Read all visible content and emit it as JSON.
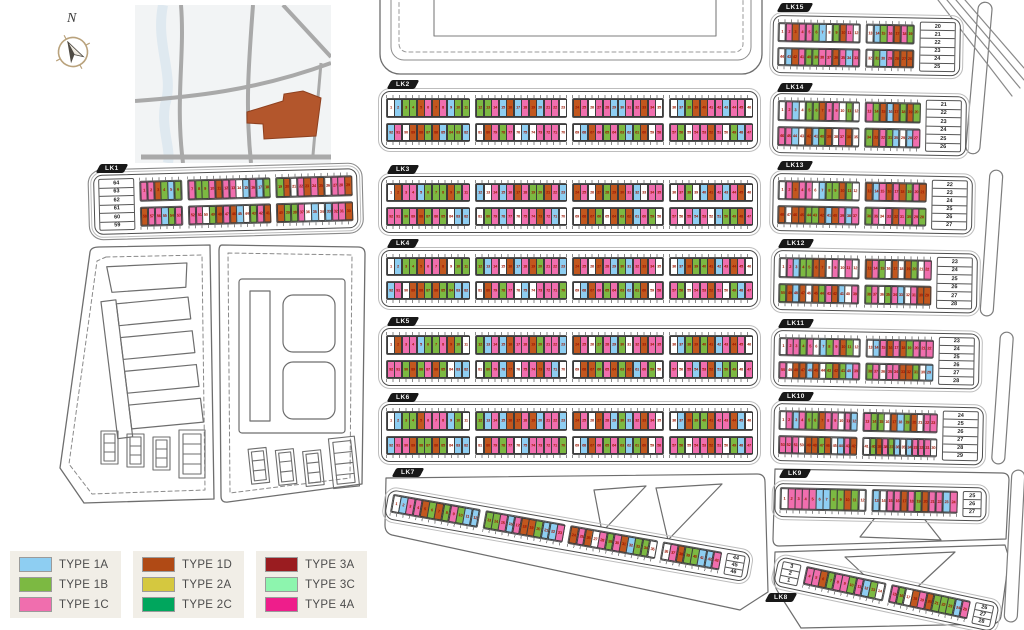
{
  "compass": {
    "label": "N"
  },
  "legend": {
    "items": [
      {
        "label": "TYPE 1A",
        "color": "#8ECEF2"
      },
      {
        "label": "TYPE 1B",
        "color": "#7CB942"
      },
      {
        "label": "TYPE 1C",
        "color": "#F06EAE"
      },
      {
        "label": "TYPE 1D",
        "color": "#B04A15"
      },
      {
        "label": "TYPE 2A",
        "color": "#D5C83F"
      },
      {
        "label": "TYPE 2C",
        "color": "#00A65D"
      },
      {
        "label": "TYPE 3A",
        "color": "#9A1C20"
      },
      {
        "label": "TYPE 3C",
        "color": "#8DF5AE"
      },
      {
        "label": "TYPE 4A",
        "color": "#EE1E8B"
      }
    ]
  },
  "palette": {
    "A": "#8ECEF2",
    "B": "#7CB942",
    "C": "#F06EAE",
    "D": "#C2571E",
    "E": "#D5C83F",
    "F": "#00A65D",
    "G": "#9A1C20",
    "H": "#8DF5AE",
    "I": "#EE1E8B",
    "W": "#FFFFFF"
  },
  "blocks": [
    {
      "id": "LK1",
      "label": "LK1",
      "kind": "tworow",
      "sideLeft": [
        64,
        63,
        62,
        61,
        60,
        59
      ],
      "groups": [
        {
          "t": [
            1,
            6
          ],
          "b": [
            58,
            53
          ]
        },
        {
          "t": [
            7,
            18
          ],
          "b": [
            52,
            41
          ]
        },
        {
          "t": [
            19,
            29
          ],
          "b": [
            40,
            30
          ]
        }
      ],
      "topColors": "CCDBABCBBCDCCWACABBDWCDCDWCCD",
      "bottomColors": "DCCABCCCWBDCDAWBCDDBBCWAWACCD"
    },
    {
      "id": "LK2",
      "label": "LK2",
      "kind": "tworow",
      "groups": [
        {
          "t": [
            1,
            11
          ],
          "b": [
            92,
            82
          ]
        },
        {
          "t": [
            12,
            23
          ],
          "b": [
            81,
            70
          ]
        },
        {
          "t": [
            24,
            35
          ],
          "b": [
            69,
            58
          ]
        },
        {
          "t": [
            36,
            46
          ],
          "b": [
            57,
            47
          ]
        }
      ],
      "topColors": "WABBDCDCABBBBCADACDACCWDCWCCAACCDCWWABDDCCACCW",
      "bottomColors": "ACWDDBDABBAWDCBCWAWCCCWWADCBCBABDWCCBWCCDCWBAC"
    },
    {
      "id": "LK3",
      "label": "LK3",
      "kind": "tworow",
      "groups": [
        {
          "t": [
            1,
            11
          ],
          "b": [
            92,
            82
          ]
        },
        {
          "t": [
            12,
            23
          ],
          "b": [
            81,
            70
          ]
        },
        {
          "t": [
            24,
            35
          ],
          "b": [
            69,
            58
          ]
        },
        {
          "t": [
            36,
            46
          ],
          "b": [
            57,
            47
          ]
        }
      ],
      "topColors": "WDCCABBBDBCAWCACDCBBDCADCWDBDDCAWCCWCBWADCACDW",
      "bottomColors": "CCBCDBCBWAAWBCACWCCDCAWWDDBWDBDACBWCWCACWABBDC"
    },
    {
      "id": "LK4",
      "label": "LK4",
      "kind": "tworow",
      "groups": [
        {
          "t": [
            1,
            11
          ],
          "b": [
            92,
            82
          ]
        },
        {
          "t": [
            12,
            23
          ],
          "b": [
            81,
            70
          ]
        },
        {
          "t": [
            24,
            35
          ],
          "b": [
            69,
            58
          ]
        },
        {
          "t": [
            36,
            46
          ],
          "b": [
            57,
            47
          ]
        }
      ],
      "topColors": "WABBDCCDWBBBACWDACDBCCADCWDCABACDCWWADBBDACDCW",
      "bottomColors": "ACWDDBDBBAAWDCBCWAWCCCBWADCBCBABDWCCBWCCDCWBAC"
    },
    {
      "id": "LK5",
      "label": "LK5",
      "kind": "tworow",
      "groups": [
        {
          "t": [
            1,
            11
          ],
          "b": [
            92,
            82
          ]
        },
        {
          "t": [
            12,
            23
          ],
          "b": [
            81,
            70
          ]
        },
        {
          "t": [
            24,
            35
          ],
          "b": [
            69,
            58
          ]
        },
        {
          "t": [
            36,
            46
          ],
          "b": [
            57,
            47
          ]
        }
      ],
      "topColors": "WDCCABBCDBWBACADCCDBCCADCWBCABWCDCCWABDBDACDCW",
      "bottomColors": "CCBDBCDBWAAWBCADWCCDCAWWDDBCDBDACBWCWCACDABBWC"
    },
    {
      "id": "LK6",
      "label": "LK6",
      "kind": "tworow",
      "groups": [
        {
          "t": [
            1,
            11
          ],
          "b": [
            92,
            82
          ]
        },
        {
          "t": [
            12,
            23
          ],
          "b": [
            81,
            70
          ]
        },
        {
          "t": [
            24,
            35
          ],
          "b": [
            69,
            58
          ]
        },
        {
          "t": [
            36,
            46
          ],
          "b": [
            57,
            47
          ]
        }
      ],
      "topColors": "WABBDCCCABWBACADDCDACCADCWDCABACDCWWADBBDCCDAW",
      "bottomColors": "ACCDBBDBWAAWDCBCWACCCCBWADCBCBABDWCCBWCCDCWBAC"
    },
    {
      "id": "LK7",
      "label": "LK7",
      "kind": "row",
      "groups": [
        {
          "r": [
            1,
            12
          ]
        },
        {
          "r": [
            13,
            23
          ]
        },
        {
          "r": [
            24,
            35
          ]
        },
        {
          "r": [
            36,
            43
          ]
        }
      ],
      "sideRight": [
        44,
        45,
        46
      ],
      "rowColors": "WACCDBDBCBAABBCACDDBAACDCDWCBCDABBWWCDBBAAC"
    },
    {
      "id": "LK8",
      "label": "LK8",
      "kind": "row",
      "sideLeft": [
        3,
        2,
        1
      ],
      "groups": [
        {
          "r": [
            4,
            14
          ]
        },
        {
          "r": [
            15,
            25
          ]
        }
      ],
      "sideRight": [
        26,
        27,
        28
      ],
      "rowColors": "CCDBCCBCABWCBWDCDBBBAC"
    },
    {
      "id": "LK9",
      "label": "LK9",
      "kind": "row",
      "groups": [
        {
          "r": [
            1,
            12
          ]
        },
        {
          "r": [
            13,
            24
          ]
        }
      ],
      "sideRight": [
        25,
        26,
        27
      ],
      "rowColors": "WCCCCAABBDBWAWCCDCBDCCAC"
    },
    {
      "id": "LK10",
      "label": "LK10",
      "kind": "tworow",
      "groups": [
        {
          "t": [
            1,
            12
          ],
          "b": [
            53,
            42
          ]
        },
        {
          "t": [
            13,
            23
          ],
          "b": [
            41,
            30
          ]
        }
      ],
      "sideRight": [
        24,
        25,
        26,
        27,
        28,
        29
      ],
      "topColors": "WCACBBDCCWCACBBWDABDWCC",
      "bottomColors": "CCCWDDBDWACDWBDCBAWACCCW"
    },
    {
      "id": "LK11",
      "label": "LK11",
      "kind": "tworow",
      "groups": [
        {
          "t": [
            1,
            12
          ],
          "b": [
            50,
            39
          ]
        },
        {
          "t": [
            13,
            22
          ],
          "b": [
            38,
            29
          ]
        }
      ],
      "sideRight": [
        23,
        24,
        25,
        26,
        27,
        28
      ],
      "topColors": "WCCBCWABCDBWWACDCDBCCC",
      "bottomColors": "CWDDADWBDBACBCWCCDDBWA"
    },
    {
      "id": "LK12",
      "label": "LK12",
      "kind": "tworow",
      "groups": [
        {
          "t": [
            1,
            12
          ],
          "b": [
            50,
            39
          ]
        },
        {
          "t": [
            13,
            22
          ],
          "b": [
            38,
            29
          ]
        }
      ],
      "sideRight": [
        23,
        24,
        25,
        26,
        27,
        28
      ],
      "topColors": "WCABBDDWCWCWDCBWDWDBWC",
      "bottomColors": "BDADWDBCDAWCBCWBCAWCDD"
    },
    {
      "id": "LK13",
      "label": "LK13",
      "kind": "tworow",
      "groups": [
        {
          "t": [
            1,
            12
          ],
          "b": [
            48,
            37
          ]
        },
        {
          "t": [
            13,
            21
          ],
          "b": [
            36,
            28
          ]
        }
      ],
      "sideRight": [
        22,
        23,
        24,
        25,
        26,
        27
      ],
      "topColors": "WCDCCWABBDBWDACDCDBCD",
      "bottomColors": "DWDDBBDADCACBCWCDCBCB"
    },
    {
      "id": "LK14",
      "label": "LK14",
      "kind": "tworow",
      "groups": [
        {
          "t": [
            1,
            12
          ],
          "b": [
            46,
            35
          ]
        },
        {
          "t": [
            13,
            20
          ],
          "b": [
            34,
            27
          ]
        }
      ],
      "sideRight": [
        21,
        22,
        23,
        24,
        25,
        26
      ],
      "topColors": "WCAWBBDCCWBWCBDADBDB",
      "bottomColors": "CCAWDABDWCDWBDCBAWAC"
    },
    {
      "id": "LK15",
      "label": "LK15",
      "kind": "tworow",
      "groups": [
        {
          "t": [
            1,
            12
          ],
          "b": [
            44,
            33
          ]
        },
        {
          "t": [
            13,
            19
          ],
          "b": [
            32,
            26
          ]
        }
      ],
      "sideRight": [
        20,
        21,
        22,
        23,
        24,
        25
      ],
      "topColors": "WCDCCBAWBDCWWABCDCB",
      "bottomColors": "WADCBBCCDCACWBACDDD"
    }
  ]
}
